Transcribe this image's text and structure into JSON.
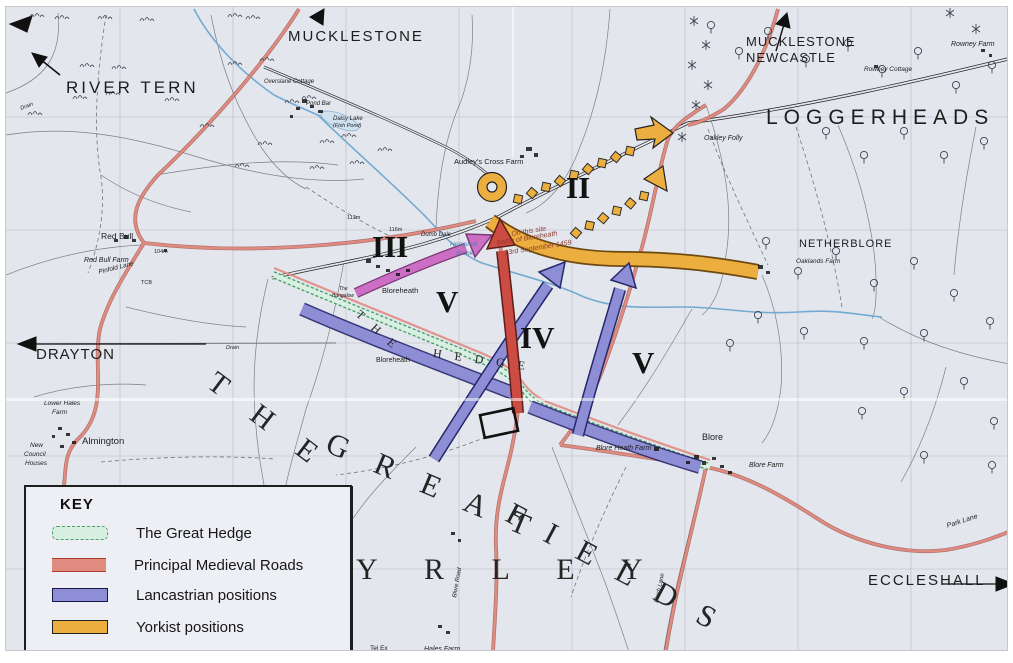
{
  "map": {
    "colors": {
      "paper": "#e3e6ed",
      "ink": "#1f1f1f",
      "road-red": "#e08b80",
      "attack-red": "#cc4b42",
      "magenta": "#cd6ec5",
      "lanc": "#8d8ed6",
      "lanc-edge": "#26266a",
      "york": "#ecae3e",
      "york-edge": "#6e4a12",
      "hedge-light": "#d8f0e2",
      "hedge-dark": "#4f9d6c",
      "stream": "#72aad2"
    },
    "key": {
      "title": "KEY",
      "items": [
        {
          "label": "The Great Hedge",
          "type": "hedge"
        },
        {
          "label": "Principal Medieval Roads",
          "type": "road"
        },
        {
          "label": "Lancastrian positions",
          "type": "lancastrian"
        },
        {
          "label": "Yorkist positions",
          "type": "yorkist"
        }
      ]
    },
    "numerals": [
      {
        "text": "II",
        "x": 560,
        "y": 165
      },
      {
        "text": "III",
        "x": 366,
        "y": 224
      },
      {
        "text": "V",
        "x": 430,
        "y": 279
      },
      {
        "text": "IV",
        "x": 514,
        "y": 315
      },
      {
        "text": "V",
        "x": 626,
        "y": 340
      }
    ],
    "display_words": [
      {
        "text": "T H E",
        "x": 214,
        "y": 360,
        "fs": 30,
        "rot": 37,
        "ls": 14
      },
      {
        "text": "G R E A T",
        "x": 328,
        "y": 420,
        "fs": 31,
        "rot": 23,
        "ls": 11
      },
      {
        "text": "F I E L D S",
        "x": 510,
        "y": 490,
        "fs": 31,
        "rot": 28,
        "ls": 9
      },
      {
        "text": "Y R L E Y",
        "x": 350,
        "y": 548,
        "fs": 30,
        "rot": 0,
        "ls": 20
      },
      {
        "text": "T H E",
        "x": 356,
        "y": 301,
        "fs": 12,
        "rot": 42,
        "ls": 5
      },
      {
        "text": "H E D G E",
        "x": 428,
        "y": 340,
        "fs": 12,
        "rot": 8,
        "ls": 5
      }
    ],
    "labels": [
      {
        "t": "MUCKLESTONE",
        "x": 282,
        "y": 22,
        "fs": 15,
        "ls": 2,
        "name": "label-mucklestone"
      },
      {
        "t": "RIVER TERN",
        "x": 60,
        "y": 72,
        "fs": 17,
        "ls": 3,
        "name": "label-river-tern"
      },
      {
        "t": "MUCKLESTONE",
        "x": 740,
        "y": 28,
        "fs": 13,
        "ls": 1,
        "name": "label-mucklestone-newcastle"
      },
      {
        "t": "NEWCASTLE",
        "x": 740,
        "y": 44,
        "fs": 13,
        "ls": 1,
        "name": "label-mucklestone-newcastle"
      },
      {
        "t": "LOGGERHEADS CP",
        "x": 760,
        "y": 100,
        "fs": 21,
        "ls": 6,
        "name": "label-loggerheads-cp"
      },
      {
        "t": "Rowney Farm",
        "x": 945,
        "y": 34,
        "fs": 7,
        "i": 1
      },
      {
        "t": "Rowney Cottage",
        "x": 858,
        "y": 60,
        "fs": 6.5,
        "i": 1
      },
      {
        "t": "Oakley Folly",
        "x": 698,
        "y": 128,
        "fs": 7,
        "i": 1
      },
      {
        "t": "NETHERBLORE",
        "x": 793,
        "y": 232,
        "fs": 11,
        "ls": 1,
        "name": "label-netherblore"
      },
      {
        "t": "Oaklands Farm",
        "x": 790,
        "y": 252,
        "fs": 6.5,
        "i": 1
      },
      {
        "t": "Audley's Cross Farm",
        "x": 448,
        "y": 151,
        "fs": 7.5,
        "name": "label-audleys-cross-farm"
      },
      {
        "t": "Red Bull",
        "x": 95,
        "y": 225,
        "fs": 8.5
      },
      {
        "t": "Red Bull Farm",
        "x": 78,
        "y": 250,
        "fs": 7,
        "i": 1
      },
      {
        "t": "Pinfold Lane",
        "x": 92,
        "y": 263,
        "fs": 6.5,
        "i": 1,
        "rot": -14
      },
      {
        "t": "104m",
        "x": 148,
        "y": 243,
        "fs": 5.5
      },
      {
        "t": "TCB",
        "x": 135,
        "y": 274,
        "fs": 5.5
      },
      {
        "t": "DRAYTON",
        "x": 30,
        "y": 340,
        "fs": 15,
        "ls": 1,
        "name": "label-drayton"
      },
      {
        "t": "Lower Hales",
        "x": 38,
        "y": 394,
        "fs": 6.5,
        "i": 1
      },
      {
        "t": "Farm",
        "x": 46,
        "y": 403,
        "fs": 6.5,
        "i": 1
      },
      {
        "t": "New",
        "x": 24,
        "y": 436,
        "fs": 6.5,
        "i": 1
      },
      {
        "t": "Council",
        "x": 18,
        "y": 445,
        "fs": 6.5,
        "i": 1
      },
      {
        "t": "Houses",
        "x": 19,
        "y": 454,
        "fs": 6.5,
        "i": 1
      },
      {
        "t": "Almington",
        "x": 76,
        "y": 430,
        "fs": 9.5
      },
      {
        "t": "Overslane Cottage",
        "x": 258,
        "y": 72,
        "fs": 6,
        "i": 1
      },
      {
        "t": "Pond Bar",
        "x": 300,
        "y": 94,
        "fs": 6,
        "i": 1
      },
      {
        "t": "Daisy Lake",
        "x": 327,
        "y": 109,
        "fs": 6,
        "i": 1
      },
      {
        "t": "(Fish Pond)",
        "x": 327,
        "y": 117,
        "fs": 5.5,
        "i": 1
      },
      {
        "t": "Drain",
        "x": 14,
        "y": 100,
        "fs": 5.5,
        "i": 1,
        "rot": -20
      },
      {
        "t": "Drain",
        "x": 220,
        "y": 339,
        "fs": 5.5,
        "i": 1
      },
      {
        "t": "Bloreheath",
        "x": 376,
        "y": 280,
        "fs": 7.5
      },
      {
        "t": "Bloreheath",
        "x": 370,
        "y": 350,
        "fs": 7
      },
      {
        "t": "The",
        "x": 333,
        "y": 280,
        "fs": 5,
        "i": 1
      },
      {
        "t": "Bungalow",
        "x": 326,
        "y": 287,
        "fs": 5,
        "i": 1
      },
      {
        "t": "116m",
        "x": 383,
        "y": 221,
        "fs": 5.5
      },
      {
        "t": "113m",
        "x": 341,
        "y": 209,
        "fs": 5.5
      },
      {
        "t": "Dumb Dale",
        "x": 415,
        "y": 225,
        "fs": 6,
        "i": 1
      },
      {
        "t": "Hempmill",
        "x": 444,
        "y": 235,
        "fs": 6.5,
        "i": 1,
        "col": "#4a7fae"
      },
      {
        "t": "Brook",
        "x": 450,
        "y": 244,
        "fs": 6.5,
        "i": 1,
        "col": "#4a7fae"
      },
      {
        "t": "On this site",
        "x": 505,
        "y": 224,
        "fs": 7,
        "i": 1,
        "rot": -9,
        "col": "#8b3a2e",
        "name": "battle-site-caption"
      },
      {
        "t": "Battle of Bloreheath",
        "x": 490,
        "y": 233,
        "fs": 7,
        "i": 1,
        "rot": -9,
        "col": "#8b3a2e",
        "name": "battle-site-caption"
      },
      {
        "t": "23rd September 1459",
        "x": 498,
        "y": 243,
        "fs": 7,
        "i": 1,
        "rot": -9,
        "col": "#8b3a2e",
        "name": "battle-site-caption"
      },
      {
        "t": "Blore",
        "x": 696,
        "y": 426,
        "fs": 9
      },
      {
        "t": "Blore Farm",
        "x": 743,
        "y": 455,
        "fs": 7,
        "i": 1
      },
      {
        "t": "Blore Heath Farm",
        "x": 590,
        "y": 438,
        "fs": 7,
        "i": 1
      },
      {
        "t": "Park Lane",
        "x": 940,
        "y": 516,
        "fs": 7,
        "i": 1,
        "rot": -18
      },
      {
        "t": "Flash Lane",
        "x": 648,
        "y": 595,
        "fs": 6,
        "i": 1,
        "rot": -78
      },
      {
        "t": "Blore Road",
        "x": 446,
        "y": 590,
        "fs": 6,
        "i": 1,
        "rot": -80
      },
      {
        "t": "Hales Farm",
        "x": 418,
        "y": 639,
        "fs": 7,
        "i": 1
      },
      {
        "t": "Tel Ex",
        "x": 364,
        "y": 639,
        "fs": 6.5
      },
      {
        "t": "ECCLESHALL",
        "x": 862,
        "y": 566,
        "fs": 15,
        "ls": 2,
        "name": "label-eccleshall"
      }
    ],
    "symbols": {
      "trees": [
        [
          705,
          22
        ],
        [
          733,
          48
        ],
        [
          762,
          28
        ],
        [
          800,
          56
        ],
        [
          842,
          40
        ],
        [
          876,
          66
        ],
        [
          912,
          48
        ],
        [
          950,
          82
        ],
        [
          986,
          62
        ],
        [
          898,
          128
        ],
        [
          938,
          152
        ],
        [
          978,
          138
        ],
        [
          858,
          152
        ],
        [
          820,
          128
        ],
        [
          760,
          238
        ],
        [
          792,
          268
        ],
        [
          830,
          248
        ],
        [
          868,
          280
        ],
        [
          908,
          258
        ],
        [
          948,
          290
        ],
        [
          984,
          318
        ],
        [
          918,
          330
        ],
        [
          858,
          338
        ],
        [
          798,
          328
        ],
        [
          958,
          378
        ],
        [
          898,
          388
        ],
        [
          988,
          418
        ],
        [
          856,
          408
        ],
        [
          918,
          452
        ],
        [
          986,
          462
        ],
        [
          752,
          312
        ],
        [
          724,
          340
        ]
      ],
      "conifers": [
        [
          688,
          14
        ],
        [
          700,
          38
        ],
        [
          686,
          58
        ],
        [
          702,
          78
        ],
        [
          690,
          98
        ],
        [
          944,
          6
        ],
        [
          970,
          22
        ],
        [
          676,
          130
        ]
      ],
      "tufts": [
        [
          30,
          8
        ],
        [
          55,
          10
        ],
        [
          98,
          10
        ],
        [
          140,
          12
        ],
        [
          228,
          8
        ],
        [
          246,
          10
        ],
        [
          80,
          58
        ],
        [
          112,
          60
        ],
        [
          73,
          90
        ],
        [
          106,
          86
        ],
        [
          28,
          106
        ],
        [
          228,
          56
        ],
        [
          260,
          52
        ],
        [
          285,
          94
        ],
        [
          302,
          90
        ],
        [
          320,
          134
        ],
        [
          342,
          128
        ],
        [
          235,
          158
        ],
        [
          258,
          136
        ],
        [
          200,
          118
        ],
        [
          165,
          92
        ],
        [
          310,
          160
        ],
        [
          350,
          155
        ],
        [
          378,
          142
        ]
      ],
      "buildings": [
        [
          296,
          92,
          5,
          4
        ],
        [
          304,
          98,
          4,
          3
        ],
        [
          290,
          100,
          4,
          3
        ],
        [
          312,
          103,
          5,
          3
        ],
        [
          284,
          108,
          3,
          3
        ],
        [
          520,
          140,
          6,
          4
        ],
        [
          528,
          146,
          4,
          4
        ],
        [
          514,
          148,
          4,
          3
        ],
        [
          360,
          252,
          5,
          4
        ],
        [
          370,
          258,
          4,
          3
        ],
        [
          380,
          262,
          4,
          3
        ],
        [
          390,
          266,
          4,
          3
        ],
        [
          400,
          262,
          4,
          3
        ],
        [
          118,
          228,
          4,
          4
        ],
        [
          126,
          232,
          4,
          3
        ],
        [
          108,
          232,
          4,
          3
        ],
        [
          52,
          420,
          4,
          3
        ],
        [
          60,
          426,
          4,
          3
        ],
        [
          46,
          428,
          3,
          3
        ],
        [
          66,
          434,
          4,
          3
        ],
        [
          54,
          438,
          4,
          3
        ],
        [
          688,
          448,
          5,
          4
        ],
        [
          696,
          454,
          4,
          4
        ],
        [
          680,
          454,
          4,
          3
        ],
        [
          706,
          450,
          4,
          3
        ],
        [
          714,
          458,
          4,
          3
        ],
        [
          722,
          464,
          4,
          3
        ],
        [
          752,
          258,
          5,
          4
        ],
        [
          760,
          264,
          4,
          3
        ],
        [
          648,
          440,
          5,
          4
        ],
        [
          445,
          525,
          4,
          3
        ],
        [
          452,
          532,
          3,
          3
        ],
        [
          432,
          618,
          4,
          3
        ],
        [
          440,
          624,
          4,
          3
        ],
        [
          975,
          42,
          4,
          3
        ],
        [
          983,
          47,
          3,
          3
        ],
        [
          868,
          58,
          4,
          3
        ],
        [
          158,
          242,
          3,
          3
        ]
      ]
    }
  }
}
